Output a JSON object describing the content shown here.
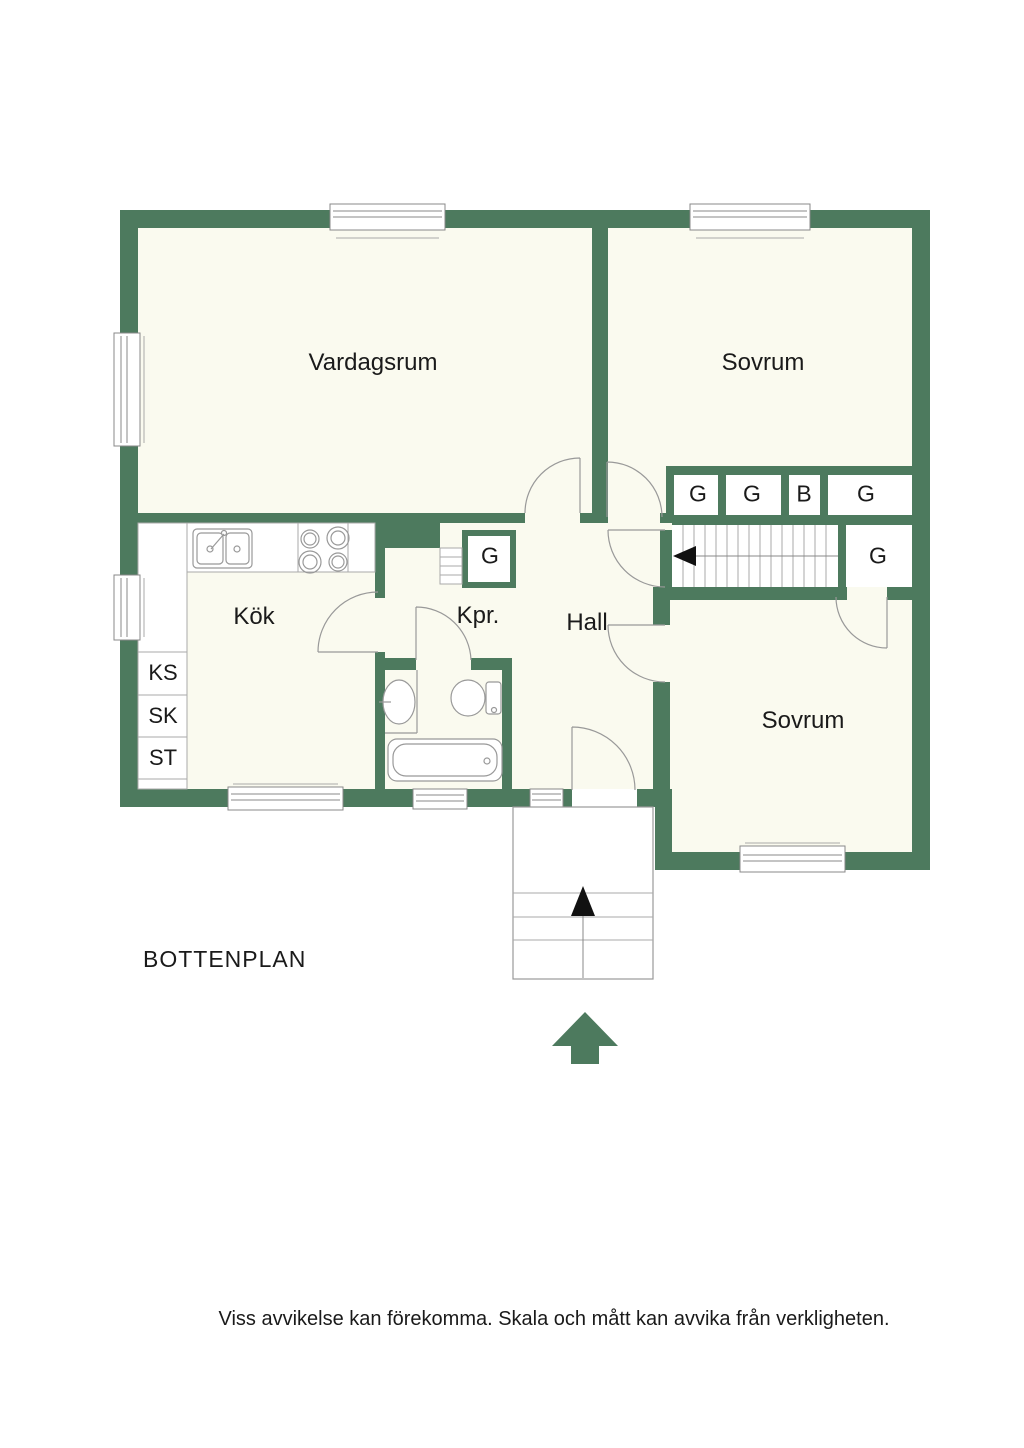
{
  "document": {
    "title": "BOTTENPLAN",
    "disclaimer": "Viss avvikelse kan förekomma. Skala och mått kan avvika från verkligheten."
  },
  "rooms": {
    "living_room": "Vardagsrum",
    "bedroom_top": "Sovrum",
    "kitchen": "Kök",
    "closet_room": "Kpr.",
    "hall": "Hall",
    "bedroom_bottom": "Sovrum"
  },
  "wardrobes": {
    "g1": "G",
    "g2": "G",
    "b": "B",
    "g3": "G",
    "g_stair": "G",
    "g_kpr": "G"
  },
  "appliances": {
    "ks": "KS",
    "sk": "SK",
    "st": "ST"
  },
  "colors": {
    "wall": "#4d7a5e",
    "floor": "#fafaef",
    "line": "#999999",
    "text": "#1a1a1a"
  }
}
